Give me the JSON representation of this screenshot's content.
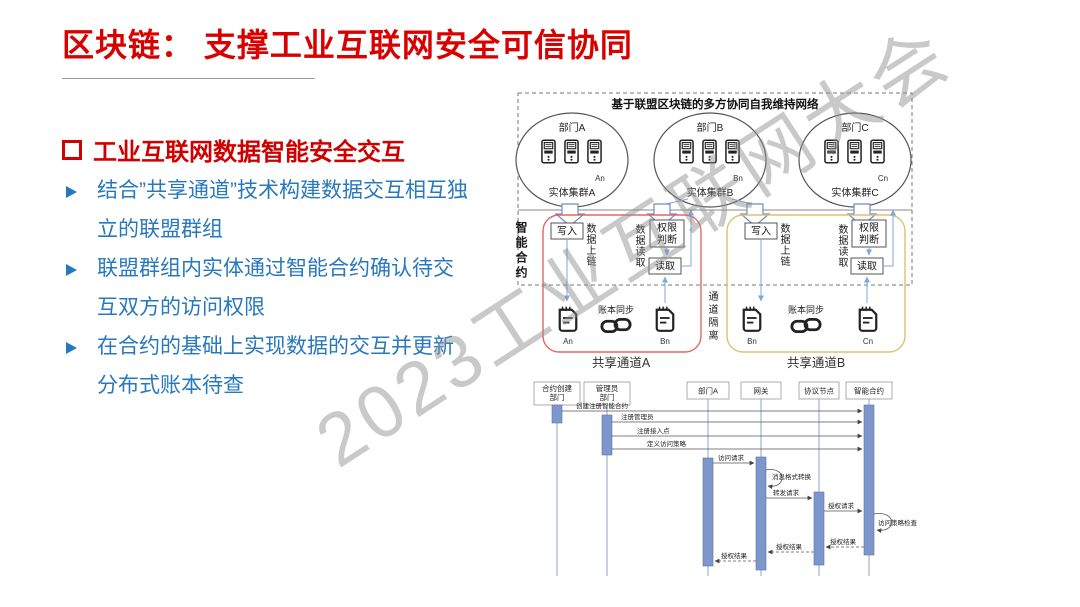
{
  "slide": {
    "title": "区块链： 支撑工业互联网安全可信协同",
    "watermark": "2023工业互联网大会"
  },
  "panel": {
    "heading": "工业互联网数据智能安全交互",
    "bullets": [
      "结合”共享通道”技术构建数据交互相互独立的联盟群组",
      "联盟群组内实体通过智能合约确认待交互双方的访问权限",
      "在合约的基础上实现数据的交互并更新分布式账本待查"
    ]
  },
  "network": {
    "title": "基于联盟区块链的多方协同自我维持网络",
    "smart_contract": "智能合约",
    "channel_isolation": "通道隔离",
    "write": "写入",
    "data_upchain": "数据上链",
    "data_read": "数据读取",
    "perm_l1": "权限",
    "perm_l2": "判断",
    "read": "读取",
    "ledger_sync": "账本同步",
    "departments": [
      {
        "name": "部门A",
        "cluster": "实体集群A",
        "node": "An"
      },
      {
        "name": "部门B",
        "cluster": "实体集群B",
        "node": "Bn"
      },
      {
        "name": "部门C",
        "cluster": "实体集群C",
        "node": "Cn"
      }
    ],
    "channels": [
      {
        "name": "共享通道A",
        "ledger_left": "An",
        "ledger_right": "Bn"
      },
      {
        "name": "共享通道B",
        "ledger_left": "Bn",
        "ledger_right": "Cn"
      }
    ]
  },
  "sequence": {
    "lifelines": [
      {
        "line1": "合约创建",
        "line2": "部门"
      },
      {
        "line1": "管理员",
        "line2": "部门"
      },
      {
        "line1": "部门A"
      },
      {
        "line1": "网关"
      },
      {
        "line1": "协议节点"
      },
      {
        "line1": "智能合约"
      }
    ],
    "messages": {
      "m1": "创建注册智能合约",
      "m2": "注册管理员",
      "m3": "注册接入点",
      "m4": "定义访问策略",
      "m5": "访问请求",
      "m6": "消息格式转换",
      "m7": "转发请求",
      "m8": "授权请求",
      "m9": "访问策略检查",
      "m10": "授权结果",
      "m11": "授权结果",
      "m12": "授权结果"
    }
  },
  "colors": {
    "title_red": "#d90000",
    "bullet_blue": "#2878be",
    "channel_a_border": "#e06666",
    "channel_b_border": "#ddc06e",
    "activation_fill": "#7d96cb",
    "arrow_blue": "#7fa8d9"
  }
}
